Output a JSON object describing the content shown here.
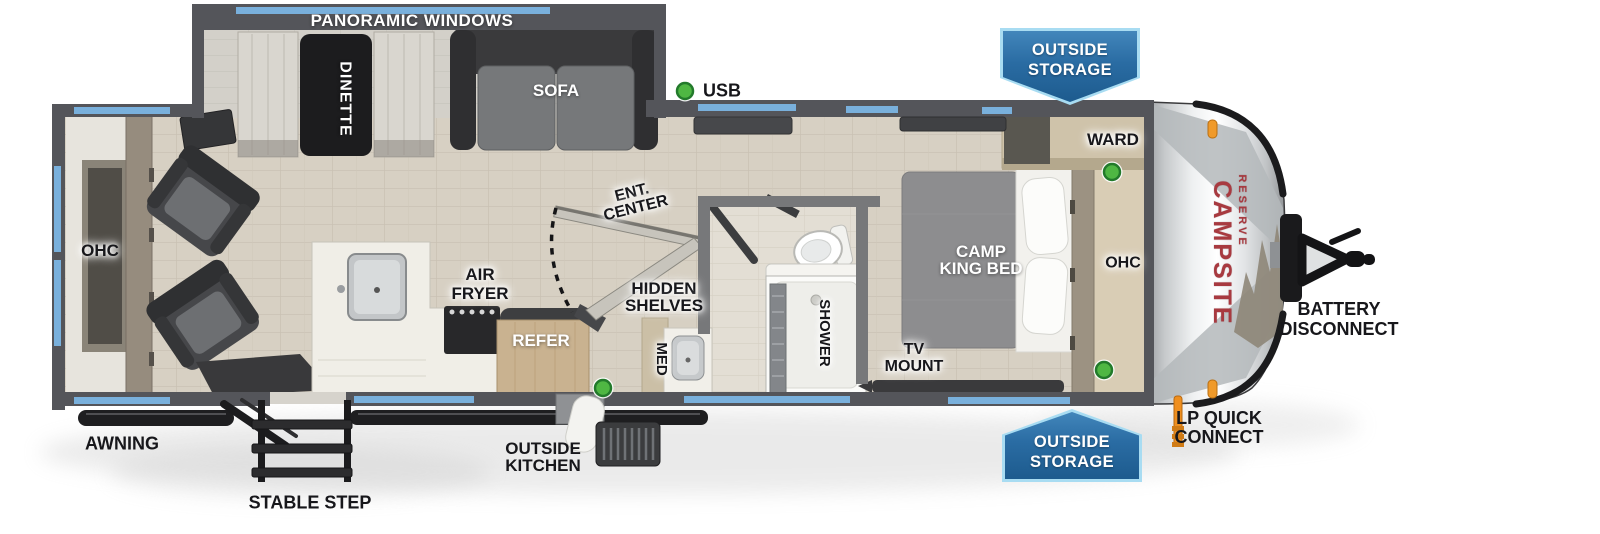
{
  "diagram": {
    "type": "travel-trailer floorplan",
    "view": "top-down"
  },
  "brand": {
    "name": "CAMPSITE",
    "sub": "RESERVE"
  },
  "labels": {
    "panoramic_windows": "PANORAMIC WINDOWS",
    "dinette": "DINETTE",
    "sofa": "SOFA",
    "usb": "USB",
    "ohc_rear": "OHC",
    "ohc_front": "OHC",
    "ward": "WARD",
    "camp_king_bed_l1": "CAMP",
    "camp_king_bed_l2": "KING BED",
    "tv_mount_l1": "TV",
    "tv_mount_l2": "MOUNT",
    "refer": "REFER",
    "air_fryer_l1": "AIR",
    "air_fryer_l2": "FRYER",
    "med": "MED",
    "hidden_shelves_l1": "HIDDEN",
    "hidden_shelves_l2": "SHELVES",
    "ent_center_l1": "ENT.",
    "ent_center_l2": "CENTER",
    "shower": "SHOWER",
    "awning": "AWNING",
    "stable_step": "STABLE STEP",
    "outside_kitchen_l1": "OUTSIDE",
    "outside_kitchen_l2": "KITCHEN",
    "lp_quick_connect_l1": "LP QUICK",
    "lp_quick_connect_l2": "CONNECT",
    "battery_disconnect_l1": "BATTERY",
    "battery_disconnect_l2": "DISCONNECT"
  },
  "badges": {
    "outside_storage_top_l1": "OUTSIDE",
    "outside_storage_top_l2": "STORAGE",
    "outside_storage_bottom_l1": "OUTSIDE",
    "outside_storage_bottom_l2": "STORAGE"
  },
  "colors": {
    "window_accent": "#79b0dc",
    "badge_fill": "#2a6ca3",
    "badge_border": "#a8dcf2",
    "usb_indicator_green": "#4fb743",
    "brand_red": "#a83a40",
    "clearance_light_orange": "#f09a2a",
    "wall_gray": "#54555a",
    "floor_wood": "#d7d0c3"
  }
}
